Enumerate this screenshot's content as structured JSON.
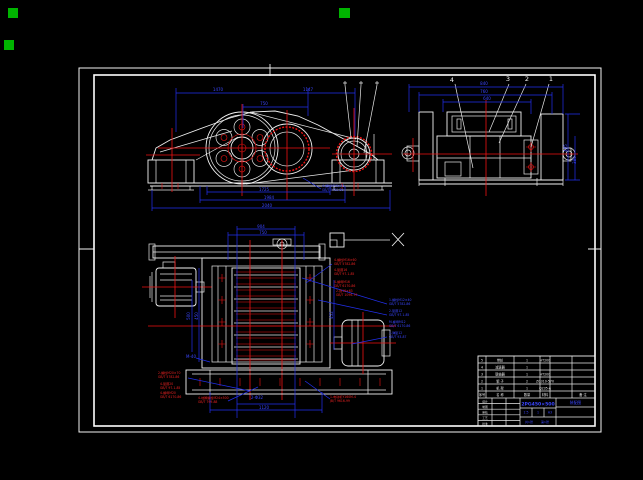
{
  "drawing": {
    "background": "#000000",
    "line_color": "#f2f2f2",
    "dimension_color": "#2230ee",
    "centerline_color": "#ee1212",
    "grip_color": "#00b400"
  },
  "grips": [
    {
      "x": 8,
      "y": 8,
      "w": 10,
      "h": 10
    },
    {
      "x": 4,
      "y": 40,
      "w": 10,
      "h": 10
    },
    {
      "x": 339,
      "y": 8,
      "w": 11,
      "h": 10
    }
  ],
  "dimension_labels": [
    {
      "x": 218,
      "y": 91,
      "t": "1470"
    },
    {
      "x": 308,
      "y": 91,
      "t": "1147"
    },
    {
      "x": 264,
      "y": 105,
      "t": "750"
    },
    {
      "x": 264,
      "y": 191,
      "t": "1725"
    },
    {
      "x": 269,
      "y": 199,
      "t": "1984"
    },
    {
      "x": 267,
      "y": 207,
      "t": "2040"
    },
    {
      "x": 484,
      "y": 85,
      "t": "840"
    },
    {
      "x": 484,
      "y": 93,
      "t": "760"
    },
    {
      "x": 487,
      "y": 100,
      "t": "640"
    },
    {
      "x": 567,
      "y": 148,
      "t": "495",
      "rot": -90
    },
    {
      "x": 576,
      "y": 160,
      "t": "380",
      "rot": -90
    },
    {
      "x": 261,
      "y": 228,
      "t": "904"
    },
    {
      "x": 263,
      "y": 234,
      "t": "750"
    },
    {
      "x": 190,
      "y": 316,
      "t": "500",
      "rot": -90
    },
    {
      "x": 198,
      "y": 316,
      "t": "450",
      "rot": -90
    },
    {
      "x": 333,
      "y": 315,
      "t": "452",
      "rot": -90
    },
    {
      "x": 257,
      "y": 399,
      "t": "2-Φ32"
    },
    {
      "x": 264,
      "y": 409,
      "t": "1120"
    },
    {
      "x": 191,
      "y": 358,
      "t": "M-40"
    }
  ],
  "balloons": [
    {
      "x": 452,
      "y": 82,
      "t": "4"
    },
    {
      "x": 508,
      "y": 81,
      "t": "3"
    },
    {
      "x": 527,
      "y": 81,
      "t": "2"
    },
    {
      "x": 551,
      "y": 81,
      "t": "1"
    }
  ],
  "notes": [
    {
      "x": 322,
      "y": 187,
      "c": "b",
      "lines": [
        "4-螺栓M16×45",
        "GB/T 5782-86"
      ]
    },
    {
      "x": 389,
      "y": 301,
      "c": "b",
      "lines": [
        "1-螺栓M12×40",
        "GB/T 5782-86"
      ]
    },
    {
      "x": 389,
      "y": 312,
      "c": "b",
      "lines": [
        "2-垫圈12",
        "GB/T 97.1-85"
      ]
    },
    {
      "x": 389,
      "y": 323,
      "c": "b",
      "lines": [
        "M-螺母M12",
        "GB/T 6170-86"
      ]
    },
    {
      "x": 389,
      "y": 334,
      "c": "b",
      "lines": [
        "1-弹垫12",
        "GB/T 93-87"
      ]
    },
    {
      "x": 334,
      "y": 261,
      "c": "r",
      "lines": [
        "4-螺栓M16×60",
        "GB/T 5782-86"
      ]
    },
    {
      "x": 334,
      "y": 271,
      "c": "r",
      "lines": [
        "4-垫圈16",
        "GB/T 97.1-85"
      ]
    },
    {
      "x": 334,
      "y": 283,
      "c": "r",
      "lines": [
        "4-螺母M16",
        "GB/T 6170-86"
      ]
    },
    {
      "x": 336,
      "y": 292,
      "c": "r",
      "lines": [
        "2-键16×63",
        "GB/T 1096-79"
      ]
    },
    {
      "x": 158,
      "y": 374,
      "c": "r",
      "lines": [
        "2-螺栓M20×70",
        "GB/T 5782-86"
      ]
    },
    {
      "x": 160,
      "y": 385,
      "c": "r",
      "lines": [
        "4-垫圈20",
        "GB/T 97.1-85"
      ]
    },
    {
      "x": 160,
      "y": 394,
      "c": "r",
      "lines": [
        "4-螺母M20",
        "GB/T 6170-86"
      ]
    },
    {
      "x": 198,
      "y": 399,
      "c": "r",
      "lines": [
        "4-地脚螺栓M24×500",
        "GB/T 799-88"
      ]
    },
    {
      "x": 330,
      "y": 398,
      "c": "r",
      "lines": [
        "1-电动机Y160M-4",
        "JB/T 9616-99"
      ]
    }
  ],
  "bom": {
    "headers": [
      "序号",
      "名 称",
      "数量",
      "材料",
      "备 注"
    ],
    "header_x": [
      482,
      500,
      527,
      545,
      583
    ],
    "rows": [
      [
        "5",
        "带轮",
        "1",
        "HT200",
        ""
      ],
      [
        "4",
        "减速器",
        "1",
        "",
        ""
      ],
      [
        "3",
        "联轴器",
        "1",
        "HT200",
        ""
      ],
      [
        "2",
        "辊 子",
        "2",
        "ZG310-570",
        ""
      ],
      [
        "1",
        "机 架",
        "1",
        "Q235-A",
        ""
      ]
    ]
  },
  "title_block": {
    "model": "2PG450×500",
    "name": "装配图",
    "scale": "1:5",
    "qty": "1",
    "paper": "A3",
    "sheets": "共1张",
    "sheet_no": "第1张",
    "sig_labels": [
      "设计",
      "制图",
      "审核",
      "工艺",
      "批准"
    ]
  }
}
